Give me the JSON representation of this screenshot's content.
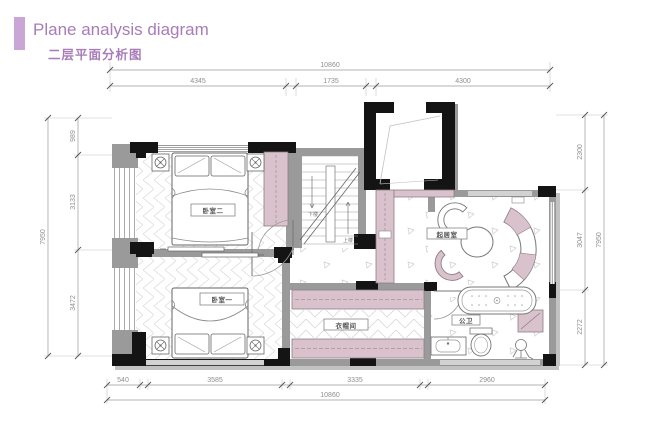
{
  "header": {
    "title": "Plane analysis diagram",
    "subtitle": "二层平面分析图"
  },
  "dims": {
    "top": {
      "total": "10860",
      "segments": [
        "4345",
        "1735",
        "4300"
      ]
    },
    "bottom": {
      "total": "10860",
      "segments": [
        "540",
        "3585",
        "3335",
        "2960"
      ]
    },
    "left": {
      "total": "7950",
      "segments": [
        "989",
        "3133",
        "3472"
      ]
    },
    "right": {
      "total": "7950",
      "segments": [
        "2300",
        "3047",
        "2272"
      ]
    }
  },
  "rooms": {
    "bedroom2": "卧室二",
    "bedroom1": "卧室一",
    "sitting": "起居室",
    "cloak": "衣帽间",
    "bath": "公卫"
  },
  "stairs": {
    "down": "下楼",
    "up": "上楼"
  },
  "colors": {
    "accent": "#a87cb8",
    "accent_bar": "#c9a6d6",
    "furniture_pink": "#dac2cd",
    "wall_black": "#141414",
    "wall_gray": "#9a9a9a",
    "dim_text": "#8f8f8f"
  }
}
